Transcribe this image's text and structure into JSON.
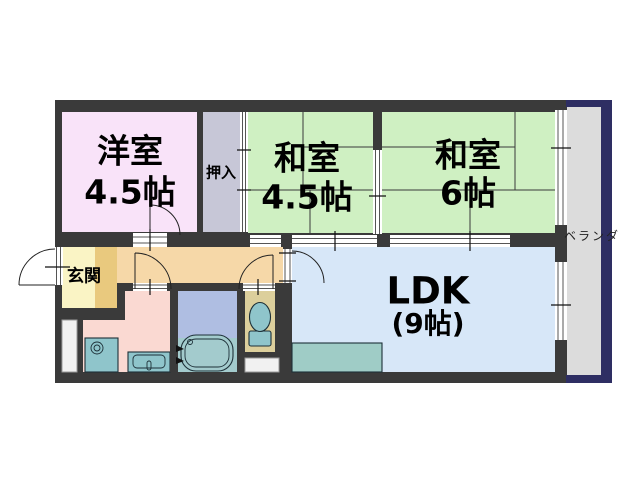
{
  "title": "apartment floor plan",
  "rooms": {
    "yoshitsu": {
      "label": "洋室",
      "size": "4.5帖",
      "color": "#F9E3F9"
    },
    "oshiire": {
      "label": "押入",
      "color": "#C7C7D7"
    },
    "washitsu45": {
      "label": "和室",
      "size": "4.5帖",
      "color": "#CFF0C2"
    },
    "washitsu6": {
      "label": "和室",
      "size": "6帖",
      "color": "#CFF0C2"
    },
    "ldk": {
      "label": "LDK",
      "size": "(9帖)",
      "color": "#D7E7F8"
    },
    "genkan": {
      "label": "玄関",
      "color": "#FAF4C5"
    },
    "veranda": {
      "label": "ベランダ",
      "color": "#DCDCDC"
    },
    "hallway": {
      "color": "#F6D8A8"
    },
    "washroom": {
      "color": "#FAD9D2"
    },
    "bathroom": {
      "floor_color": "#A3CBCD",
      "upper_color": "#AFBEE2"
    },
    "toilet_room": {
      "color": "#DCCF9C"
    }
  },
  "fixtures": [
    "bathtub",
    "toilet",
    "wash-basin",
    "washing-machine-pan",
    "kitchen-counter",
    "entrance-step",
    "pipe-space"
  ],
  "colors": {
    "wall": "#3A3A3A",
    "veranda_border": "#2E2E63",
    "fixture_teal": "#8FC5CB",
    "kitchen_counter": "#9FCCC6",
    "entrance_step": "#E9C97E",
    "background": "#FFFFFF"
  }
}
